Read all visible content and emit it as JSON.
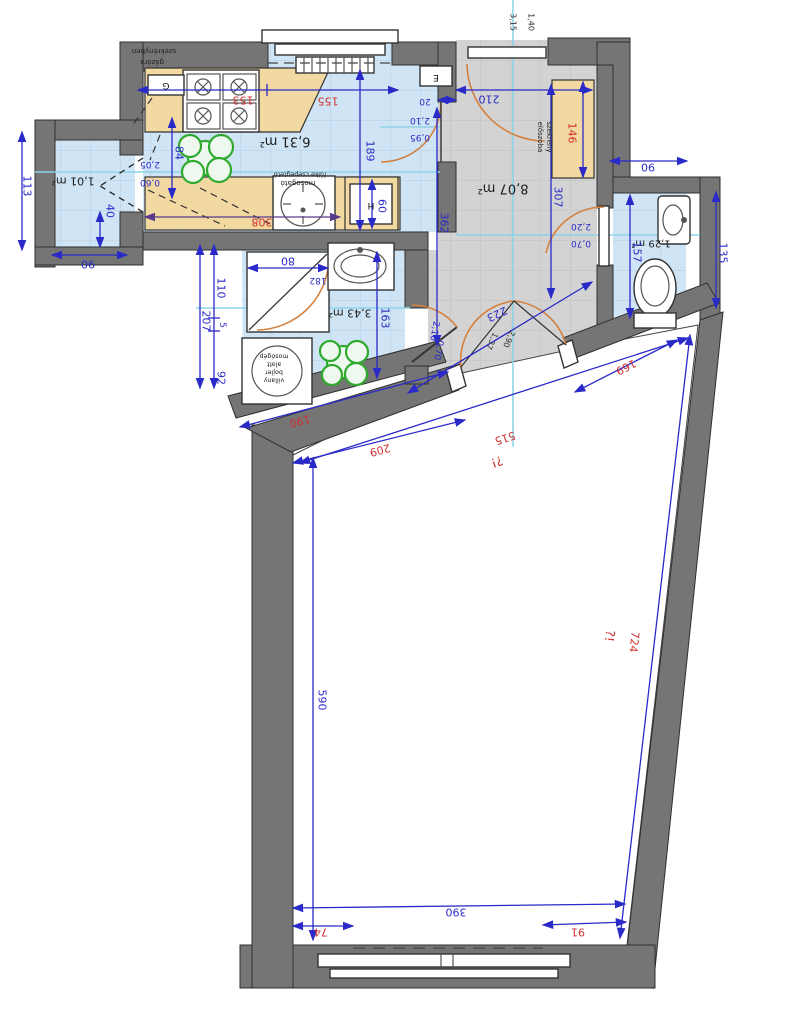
{
  "plan_type": "apartment floor plan (rotated 180°)",
  "colors": {
    "wall": "#757575",
    "floor_blue": "#cfe4f4",
    "floor_gray": "#d3d3d3",
    "floor_living": "#ffffff",
    "cabinet_tan": "#f2d9a2",
    "dim_blue": "#2a2ac8",
    "dim_red": "#d03030",
    "door_arc_orange": "#d4813f",
    "section_line_cyan": "#8fd3e8",
    "plant_green": "#2faa2f"
  },
  "rooms": [
    {
      "name": "kitchen",
      "area": "6,31 m²"
    },
    {
      "name": "storage",
      "area": "1,01 m²"
    },
    {
      "name": "hallway",
      "area": "8,07 m²"
    },
    {
      "name": "wc",
      "area": "1,29 m²"
    },
    {
      "name": "bathroom",
      "area": "3,43 m²"
    }
  ],
  "texts": {
    "kitchen_area": "6,31 m²",
    "storage_area": "1,01 m²",
    "hall_area": "8,07 m²",
    "wc_area": "1,29 m²",
    "bath_area": "3,43 m²",
    "gas_l1": "gázóra",
    "gas_l2": "szekrényben",
    "sink_l1": "fülke csepegtető",
    "sink_l2": "mosogató",
    "wm_l1": "villany",
    "wm_l2": "bojler",
    "wm_l3": "alatt",
    "wm_l4": "mosógép",
    "cab_l1": "előszoba",
    "cab_l2": "szekrény",
    "note_140": "1,40",
    "note_315": "3,15",
    "dd_137": "1,37",
    "dd_290": "2,90",
    "box_e": "E",
    "box_g": "G",
    "box_h": "H",
    "d113": "113",
    "d90a": "90",
    "d40": "40",
    "d84": "84",
    "d205": "2,05",
    "d060": "0,60",
    "d189": "189",
    "d60": "60",
    "d20": "20",
    "d210a": "2,10",
    "d095": "0,95",
    "d210": "210",
    "d362": "362",
    "d307": "307",
    "d90b": "90",
    "d135": "135",
    "d157": "157",
    "d220": "2,20",
    "d070a": "0,70",
    "d223": "223",
    "d110": "110",
    "d207": "207",
    "d5": "5",
    "d92": "92",
    "d80": "80",
    "d182": "182",
    "d163": "163",
    "d210b": "2,10",
    "d070b": "0,70",
    "d590": "590",
    "d390": "390",
    "r153": "153",
    "r155": "155",
    "r308": "308",
    "r146": "146",
    "r190": "190",
    "r209": "209",
    "r169": "169",
    "r515": "515",
    "r724": "724",
    "rq1": "?!",
    "rq2": "?!",
    "r74": "74",
    "r91": "91"
  }
}
